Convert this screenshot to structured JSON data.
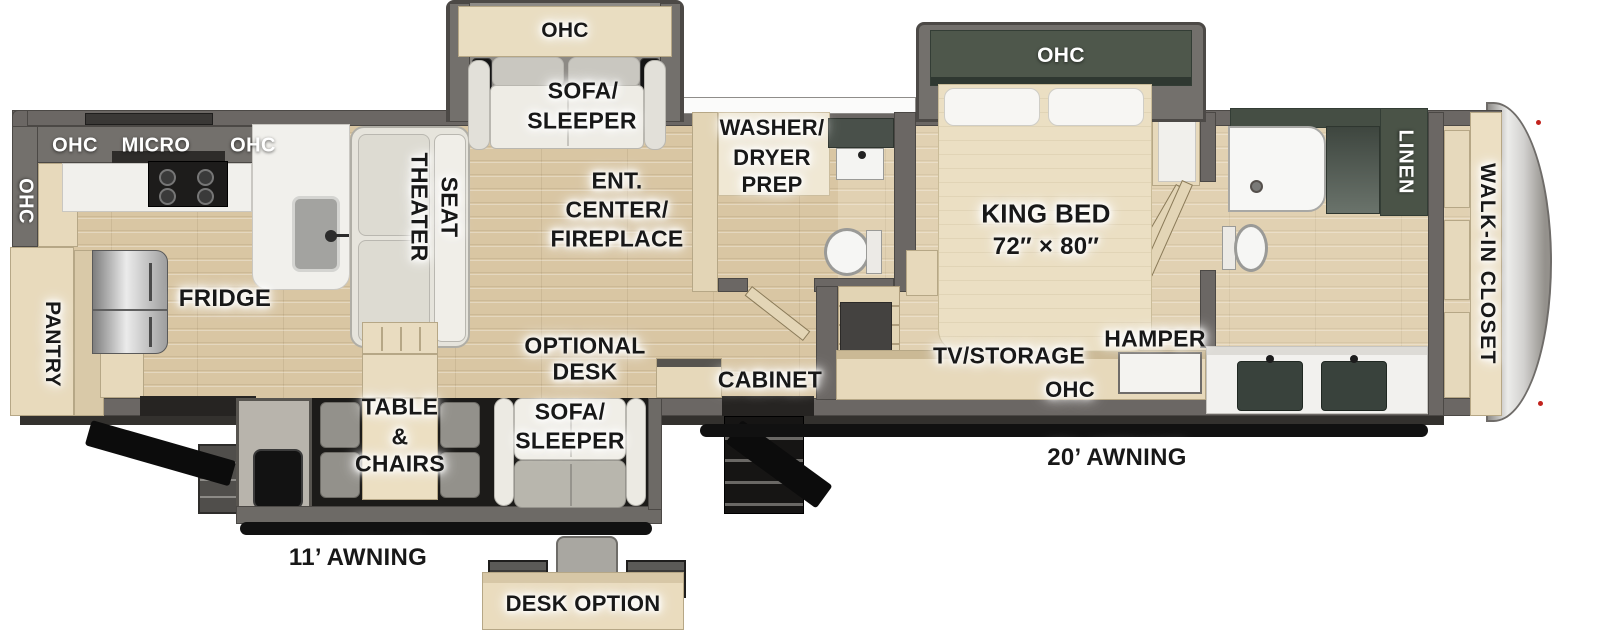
{
  "colors": {
    "floor_wood": "#d9c6a3",
    "wall_gray": "#6b6764",
    "cabinet_wood": "#e7d9bb",
    "dark_green_cabinet": "#4e574b",
    "counter_white": "#f1f0ec",
    "slide_floor_black": "#1c1b19",
    "front_cap_silver": "#d2d1cf",
    "marker_light_red": "#c2231d",
    "label_black": "#181818",
    "label_white": "#ffffff"
  },
  "labels": {
    "rear_ohc": "OHC",
    "kitchen_ohc_left": "OHC",
    "kitchen_micro": "MICRO",
    "kitchen_ohc_right": "OHC",
    "pantry": "PANTRY",
    "fridge": "FRIDGE",
    "theater_l1": "THEATER",
    "theater_l2": "SEAT",
    "living_slide_ohc": "OHC",
    "living_sofa_l1": "SOFA/",
    "living_sofa_l2": "SLEEPER",
    "ent_l1": "ENT.",
    "ent_l2": "CENTER/",
    "ent_l3": "FIREPLACE",
    "wd_l1": "WASHER/",
    "wd_l2": "DRYER",
    "wd_l3": "PREP",
    "bed_slide_ohc": "OHC",
    "king_l1": "KING BED",
    "king_l2": "72″ × 80″",
    "linen": "LINEN",
    "walkin": "WALK-IN CLOSET",
    "tv_storage": "TV/STORAGE",
    "hamper": "HAMPER",
    "bedroom_ohc": "OHC",
    "cabinet": "CABINET",
    "opt_desk_l1": "OPTIONAL",
    "opt_desk_l2": "DESK",
    "sofa2_l1": "SOFA/",
    "sofa2_l2": "SLEEPER",
    "table_l1": "TABLE",
    "table_l2": "&",
    "table_l3": "CHAIRS",
    "awning20": "20’ AWNING",
    "awning11": "11’ AWNING",
    "desk_option": "DESK OPTION"
  }
}
